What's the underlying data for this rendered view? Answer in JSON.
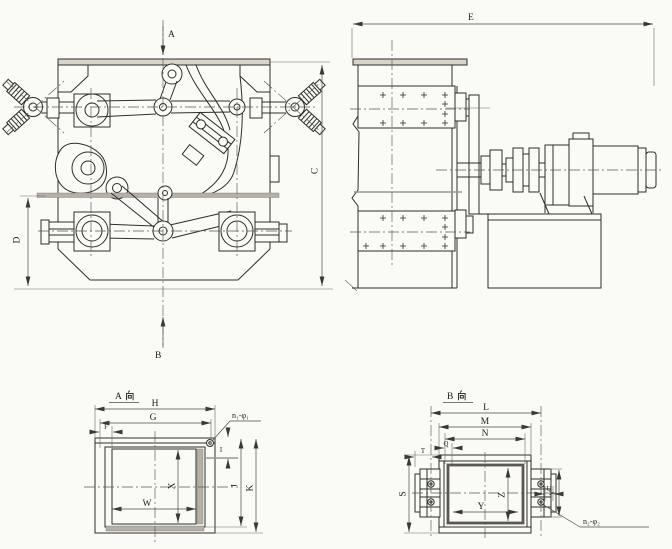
{
  "drawing_type": "engineering outline drawing, crusher with drive unit, four views",
  "front_view": {
    "view_arrow_top": "A",
    "view_arrow_bottom": "B",
    "dim_right": "C",
    "dim_left": "D"
  },
  "side_view": {
    "dim_top": "E"
  },
  "view_a": {
    "title": "A向",
    "title_letter": "A",
    "title_suffix": "向",
    "dim_h": "H",
    "dim_g": "G",
    "dim_f": "F",
    "dim_w": "W",
    "dim_x": "X",
    "dim_i": "I",
    "dim_j": "J",
    "dim_k": "K",
    "hole_note": "n₁-φ₁"
  },
  "view_b": {
    "title": "B向",
    "title_letter": "B",
    "title_suffix": "向",
    "dim_l": "L",
    "dim_m": "M",
    "dim_n": "N",
    "dim_q": "Q",
    "dim_s": "S",
    "dim_t": "T",
    "dim_u": "U",
    "dim_v": "V",
    "dim_y": "Y",
    "dim_z": "Z",
    "hole_note": "n₂-φ₂"
  },
  "colors": {
    "paper": "#fafaf6",
    "line": "#2f2d2a",
    "dim_line": "#4a4845",
    "centerline": "#5a5855",
    "gray_fill": "#b4b0a7",
    "dark_frame": "#5b5852",
    "plate_fill": "#d8d4ca"
  }
}
